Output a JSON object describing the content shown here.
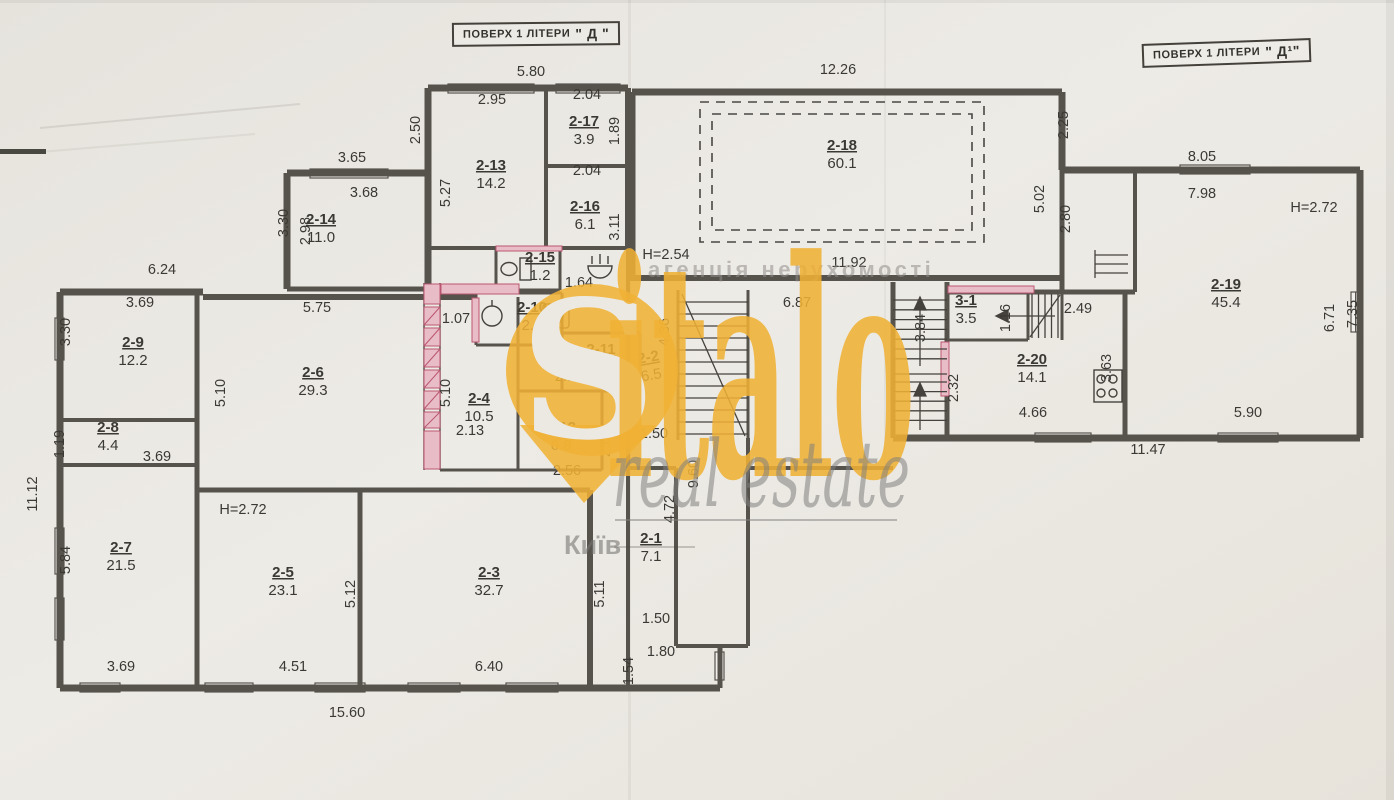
{
  "colors": {
    "paper": "#e9e6e1",
    "ink": "#3b3934",
    "wall": "#56524c",
    "pink": "#e8bdc7",
    "pink_line": "#bb5670",
    "watermark_yellow": "#f0b135",
    "watermark_gray": "#8f8d8a"
  },
  "stamps": {
    "left_prefix": "ПОВЕРХ 1 ЛІТЕРИ",
    "left_letter": "\" Д \"",
    "right_prefix": "ПОВЕРХ 1 ЛІТЕРИ",
    "right_letter": "\" Д¹\""
  },
  "watermark": {
    "monogram": "S",
    "brand": "italo",
    "tagline": "real estate",
    "city": "Київ",
    "agency": "агенція нерухомості"
  },
  "icons": [
    "toilet-icon",
    "sink-icon",
    "washbasin-icon",
    "washing-machine-icon",
    "stove-icon",
    "stairs-icon",
    "location-pin-icon"
  ],
  "rooms": [
    {
      "id": "2-13",
      "area": "14.2",
      "x": 491,
      "y": 170
    },
    {
      "id": "2-17",
      "area": "3.9",
      "x": 584,
      "y": 126
    },
    {
      "id": "2-16",
      "area": "6.1",
      "x": 585,
      "y": 211
    },
    {
      "id": "2-15",
      "area": "1.2",
      "x": 540,
      "y": 262
    },
    {
      "id": "2-14",
      "area": "11.0",
      "x": 321,
      "y": 224
    },
    {
      "id": "2-18",
      "area": "60.1",
      "x": 842,
      "y": 150
    },
    {
      "id": "2-9",
      "area": "12.2",
      "x": 133,
      "y": 347
    },
    {
      "id": "2-8",
      "area": "4.4",
      "x": 108,
      "y": 432
    },
    {
      "id": "2-6",
      "area": "29.3",
      "x": 313,
      "y": 377
    },
    {
      "id": "2-4",
      "area": "10.5",
      "x": 479,
      "y": 403
    },
    {
      "id": "2-10",
      "area": "2.4",
      "x": 532,
      "y": 312
    },
    {
      "id": "2-11",
      "area": "3.3",
      "x": 601,
      "y": 354
    },
    {
      "id": "2-12",
      "area": "6.8",
      "x": 561,
      "y": 432
    },
    {
      "id": "2-2",
      "area": "6.5",
      "x": 649,
      "y": 362,
      "r": -10
    },
    {
      "id": "2-7",
      "area": "21.5",
      "x": 121,
      "y": 552
    },
    {
      "id": "2-5",
      "area": "23.1",
      "x": 283,
      "y": 577
    },
    {
      "id": "2-3",
      "area": "32.7",
      "x": 489,
      "y": 577
    },
    {
      "id": "2-1",
      "area": "7.1",
      "x": 651,
      "y": 543
    },
    {
      "id": "2-19",
      "area": "45.4",
      "x": 1226,
      "y": 289
    },
    {
      "id": "2-20",
      "area": "14.1",
      "x": 1032,
      "y": 364
    },
    {
      "id": "3-1",
      "area": "3.5",
      "x": 966,
      "y": 305
    }
  ],
  "dims": [
    {
      "t": "5.80",
      "x": 531,
      "y": 76
    },
    {
      "t": "2.95",
      "x": 492,
      "y": 104
    },
    {
      "t": "2.04",
      "x": 587,
      "y": 99
    },
    {
      "t": "1.89",
      "x": 619,
      "y": 131,
      "r": 1
    },
    {
      "t": "2.04",
      "x": 587,
      "y": 175
    },
    {
      "t": "3.11",
      "x": 619,
      "y": 227,
      "r": 1
    },
    {
      "t": "2.50",
      "x": 420,
      "y": 130,
      "r": 1
    },
    {
      "t": "5.27",
      "x": 450,
      "y": 193,
      "r": 1
    },
    {
      "t": "3.65",
      "x": 352,
      "y": 162
    },
    {
      "t": "3.68",
      "x": 364,
      "y": 197
    },
    {
      "t": "3.30",
      "x": 288,
      "y": 223,
      "r": 1
    },
    {
      "t": "2.98",
      "x": 310,
      "y": 231,
      "r": 1
    },
    {
      "t": "12.26",
      "x": 838,
      "y": 74
    },
    {
      "t": "2.25",
      "x": 1068,
      "y": 125,
      "r": 1
    },
    {
      "t": "8.05",
      "x": 1202,
      "y": 161
    },
    {
      "t": "7.98",
      "x": 1202,
      "y": 198
    },
    {
      "t": "H=2.72",
      "x": 1314,
      "y": 212
    },
    {
      "t": "5.02",
      "x": 1044,
      "y": 199,
      "r": 1
    },
    {
      "t": "2.80",
      "x": 1070,
      "y": 219,
      "r": 1
    },
    {
      "t": "11.92",
      "x": 849,
      "y": 267
    },
    {
      "t": "H=2.54",
      "x": 666,
      "y": 259
    },
    {
      "t": "6.24",
      "x": 162,
      "y": 274
    },
    {
      "t": "1.64",
      "x": 579,
      "y": 287
    },
    {
      "t": "1.07",
      "x": 456,
      "y": 323
    },
    {
      "t": "5.75",
      "x": 317,
      "y": 312
    },
    {
      "t": "3.69",
      "x": 140,
      "y": 307
    },
    {
      "t": "3.30",
      "x": 70,
      "y": 332,
      "r": 1
    },
    {
      "t": "5.10",
      "x": 225,
      "y": 393,
      "r": 1
    },
    {
      "t": "5.10",
      "x": 450,
      "y": 393,
      "r": 1
    },
    {
      "t": "2.13",
      "x": 470,
      "y": 435
    },
    {
      "t": "1.19",
      "x": 64,
      "y": 444,
      "r": 1
    },
    {
      "t": "3.69",
      "x": 157,
      "y": 461
    },
    {
      "t": "2.16",
      "x": 569,
      "y": 381
    },
    {
      "t": "2.67",
      "x": 610,
      "y": 443,
      "r": 1
    },
    {
      "t": "2.56",
      "x": 567,
      "y": 475
    },
    {
      "t": "6.87",
      "x": 797,
      "y": 307
    },
    {
      "t": "4.36",
      "x": 669,
      "y": 332,
      "r": 1
    },
    {
      "t": "3.84",
      "x": 925,
      "y": 328,
      "r": 1
    },
    {
      "t": "1.16",
      "x": 1010,
      "y": 318,
      "r": 1
    },
    {
      "t": "2.49",
      "x": 1078,
      "y": 313
    },
    {
      "t": "3.63",
      "x": 1111,
      "y": 368,
      "r": 1
    },
    {
      "t": "2.32",
      "x": 958,
      "y": 388,
      "r": 1
    },
    {
      "t": "4.66",
      "x": 1033,
      "y": 417
    },
    {
      "t": "5.90",
      "x": 1248,
      "y": 417
    },
    {
      "t": "11.47",
      "x": 1148,
      "y": 454
    },
    {
      "t": "6.71",
      "x": 1334,
      "y": 318,
      "r": 1
    },
    {
      "t": "7.35",
      "x": 1357,
      "y": 314,
      "r": 1
    },
    {
      "t": "1.50",
      "x": 654,
      "y": 438
    },
    {
      "t": "9.60",
      "x": 698,
      "y": 474,
      "r": 1
    },
    {
      "t": "H=2.72",
      "x": 243,
      "y": 514
    },
    {
      "t": "5.84",
      "x": 70,
      "y": 560,
      "r": 1
    },
    {
      "t": "11.12",
      "x": 37,
      "y": 494,
      "r": 1
    },
    {
      "t": "5.12",
      "x": 355,
      "y": 594,
      "r": 1
    },
    {
      "t": "5.11",
      "x": 604,
      "y": 594,
      "r": 1
    },
    {
      "t": "4.72",
      "x": 674,
      "y": 509,
      "r": 1
    },
    {
      "t": "1.50",
      "x": 656,
      "y": 623
    },
    {
      "t": "1.80",
      "x": 661,
      "y": 656
    },
    {
      "t": "1.54",
      "x": 633,
      "y": 671,
      "r": 1
    },
    {
      "t": "3.69",
      "x": 121,
      "y": 671
    },
    {
      "t": "4.51",
      "x": 293,
      "y": 671
    },
    {
      "t": "6.40",
      "x": 489,
      "y": 671
    },
    {
      "t": "15.60",
      "x": 347,
      "y": 717
    }
  ]
}
